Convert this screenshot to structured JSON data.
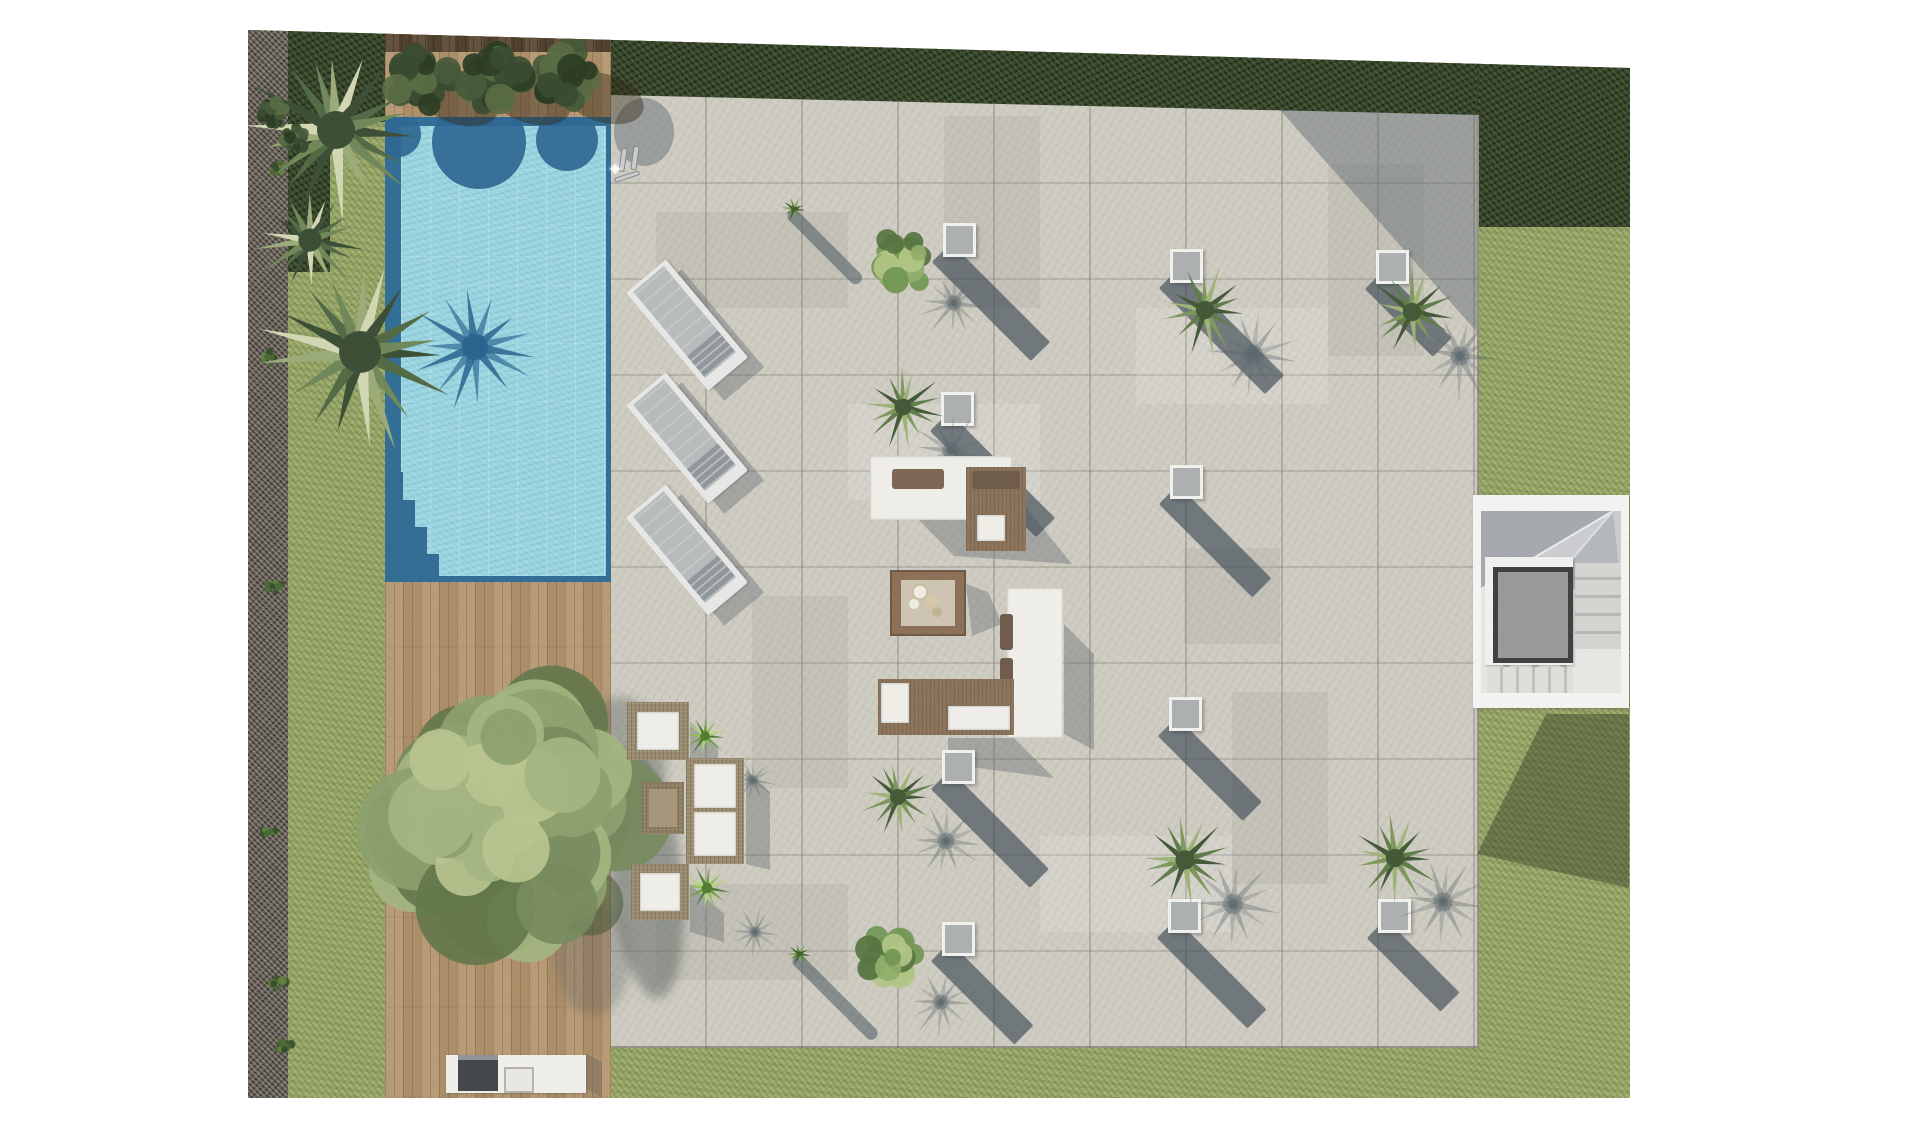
{
  "meta": {
    "title": "Villa garden site plan - top view render",
    "view": "top-down",
    "no_visible_text": true
  },
  "palette": {
    "page_bg": "#ffffff",
    "lawn": "#9cab69",
    "hedge": "#2c3b24",
    "gravel": "#565049",
    "pool_water": "#97d6e2",
    "pool_deep": "#2d6b95",
    "stone_patio": "#cfccc2",
    "cast_shadow": "#3a4854",
    "wood_deck": "#b4946c",
    "wood_dark": "#57452f",
    "rattan": "#998a6d",
    "cushion_white": "#f2f1ec",
    "cushion_brown": "#8a7259",
    "planter_cube": "#adb0b1",
    "palm_greens": [
      "#3f5533",
      "#5c7a45",
      "#7b9759",
      "#9db374"
    ],
    "fan_palm_greens": [
      "#374a30",
      "#4e6741",
      "#6d8656",
      "#9aab77",
      "#d3d8b4"
    ],
    "tree_olives": [
      "#5f7547",
      "#74895a",
      "#8ba06b",
      "#a3b57f"
    ],
    "bright_greens": [
      "#4f7a2e",
      "#6fa13f",
      "#8fc052",
      "#b4d877"
    ],
    "hedge_ball_greens": [
      "#26371e",
      "#33472a",
      "#415634",
      "#55693f"
    ],
    "stairs": "#f6f6f5",
    "elevator": "#97999a"
  },
  "scene": {
    "planters": [
      {
        "x": 695,
        "y": 201,
        "len": 140
      },
      {
        "x": 693,
        "y": 370,
        "len": 150
      },
      {
        "x": 694,
        "y": 728,
        "len": 140
      },
      {
        "x": 694,
        "y": 900,
        "len": 118
      },
      {
        "x": 922,
        "y": 227,
        "len": 150
      },
      {
        "x": 922,
        "y": 443,
        "len": 132
      },
      {
        "x": 921,
        "y": 675,
        "len": 120
      },
      {
        "x": 920,
        "y": 877,
        "len": 128
      },
      {
        "x": 1128,
        "y": 228,
        "len": 96
      },
      {
        "x": 1130,
        "y": 877,
        "len": 104
      }
    ],
    "plants": [
      {
        "x": 658,
        "y": 237,
        "r": 36,
        "kind": "shrub",
        "sh": 1
      },
      {
        "x": 655,
        "y": 385,
        "r": 42,
        "kind": "palm",
        "sh": 1
      },
      {
        "x": 650,
        "y": 775,
        "r": 40,
        "kind": "palm",
        "sh": 1
      },
      {
        "x": 645,
        "y": 936,
        "r": 36,
        "kind": "shrub",
        "sh": 1
      },
      {
        "x": 957,
        "y": 288,
        "r": 46,
        "kind": "palm",
        "sh": 1
      },
      {
        "x": 937,
        "y": 838,
        "r": 48,
        "kind": "palm",
        "sh": 1
      },
      {
        "x": 1164,
        "y": 290,
        "r": 46,
        "kind": "palm",
        "sh": 1
      },
      {
        "x": 1147,
        "y": 836,
        "r": 46,
        "kind": "palm",
        "sh": 1
      },
      {
        "x": 88,
        "y": 108,
        "r": 95,
        "kind": "fan"
      },
      {
        "x": 112,
        "y": 330,
        "r": 105,
        "kind": "fan"
      },
      {
        "x": 62,
        "y": 218,
        "r": 58,
        "kind": "fan"
      },
      {
        "x": 263,
        "y": 792,
        "r": 148,
        "kind": "tree"
      },
      {
        "x": 457,
        "y": 714,
        "r": 24,
        "kind": "bright",
        "sh": 1
      },
      {
        "x": 459,
        "y": 866,
        "r": 26,
        "kind": "bright",
        "sh": 1
      },
      {
        "x": 176,
        "y": 59,
        "r": 38,
        "kind": "hedgeball",
        "shE": 1
      },
      {
        "x": 248,
        "y": 58,
        "r": 38,
        "kind": "hedgeball",
        "shE": 1
      },
      {
        "x": 321,
        "y": 57,
        "r": 38,
        "kind": "hedgeball",
        "shE": 1
      },
      {
        "x": 25,
        "y": 92,
        "r": 17,
        "kind": "hedgeball"
      },
      {
        "x": 47,
        "y": 116,
        "r": 15,
        "kind": "hedgeball"
      }
    ],
    "small_plants": [
      {
        "x": 540,
        "y": 181,
        "len": 100
      },
      {
        "x": 545,
        "y": 926,
        "len": 115
      }
    ],
    "loungers": [
      {
        "x": 382,
        "y": 243
      },
      {
        "x": 382,
        "y": 356
      },
      {
        "x": 382,
        "y": 468
      }
    ],
    "pool_blobs": [
      {
        "x": 94,
        "y": 25,
        "r": 47
      },
      {
        "x": 182,
        "y": 23,
        "r": 31
      },
      {
        "x": 13,
        "y": 17,
        "r": 23
      }
    ],
    "pool_steps": [
      {
        "x": 0,
        "y": 355,
        "w": 18,
        "h": 110
      },
      {
        "x": 18,
        "y": 383,
        "w": 12,
        "h": 82
      },
      {
        "x": 30,
        "y": 410,
        "w": 12,
        "h": 55
      },
      {
        "x": 42,
        "y": 437,
        "w": 12,
        "h": 28
      }
    ],
    "patio_patches": [
      {
        "x": 45,
        "y": 130,
        "w": 192,
        "h": 96
      },
      {
        "x": 333,
        "y": 34,
        "w": 96,
        "h": 192
      },
      {
        "x": 525,
        "y": 226,
        "w": 192,
        "h": 96
      },
      {
        "x": 141,
        "y": 514,
        "w": 96,
        "h": 192
      },
      {
        "x": 621,
        "y": 610,
        "w": 96,
        "h": 192
      },
      {
        "x": 429,
        "y": 754,
        "w": 192,
        "h": 96
      },
      {
        "x": 45,
        "y": 802,
        "w": 192,
        "h": 96
      },
      {
        "x": 717,
        "y": 82,
        "w": 96,
        "h": 192
      },
      {
        "x": 237,
        "y": 322,
        "w": 192,
        "h": 96
      },
      {
        "x": 573,
        "y": 466,
        "w": 96,
        "h": 96
      }
    ],
    "tufts": [
      {
        "x": 18,
        "y": 90
      },
      {
        "x": 26,
        "y": 140
      },
      {
        "x": 15,
        "y": 330
      },
      {
        "x": 21,
        "y": 560
      },
      {
        "x": 15,
        "y": 805
      },
      {
        "x": 23,
        "y": 955
      },
      {
        "x": 30,
        "y": 1020
      }
    ]
  }
}
